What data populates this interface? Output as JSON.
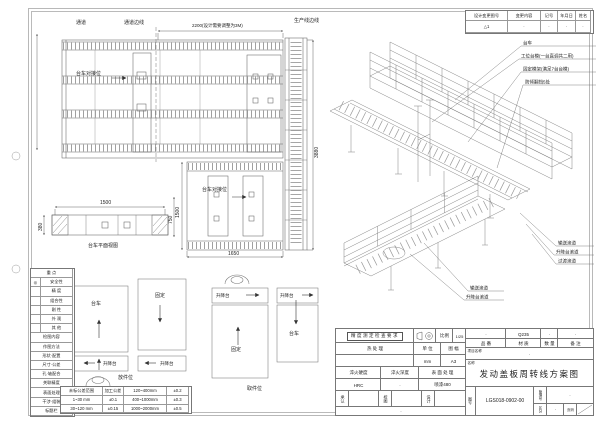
{
  "revision": {
    "headers": [
      "设计变更图号",
      "变更内容",
      "记号",
      "年月日",
      "姓名"
    ],
    "row": [
      "△1",
      "·",
      "·",
      "·",
      "·"
    ]
  },
  "plan_top": {
    "channel": "通道",
    "channel_edge": "通道边线",
    "dim_width": "2200(设计需要调整为3M)",
    "prod_edge": "生产线边线",
    "dock": "台车对接位",
    "dim_height": "3880"
  },
  "plan_lower": {
    "dock": "台车对接位",
    "dim_width": "1650",
    "dim_height": "1500"
  },
  "trolley": {
    "dim_length": "1500",
    "dim_width": "380",
    "dim_height": "750",
    "caption": "台车平面视图"
  },
  "iso": {
    "callouts_top": [
      "台车",
      "工位台模(一台直调共二用)",
      "固定模架(满足7台台模)",
      "防倾翻挡5处"
    ],
    "callouts_right": [
      "输送滚道",
      "升降台滚道",
      "过渡滚道"
    ],
    "callouts_bottom": [
      "输送滚道",
      "升降台滚道"
    ]
  },
  "schematic": {
    "trolley": "台车",
    "fixed": "固定",
    "lift": "升降台",
    "load_caption": "放件位",
    "unload_caption": "取件位"
  },
  "legend": {
    "title": "重  点",
    "rows": [
      {
        "mark": "◎",
        "label": "安全性"
      },
      {
        "mark": "",
        "label": "精  度"
      },
      {
        "mark": "",
        "label": "组合性"
      },
      {
        "mark": "",
        "label": "刚  性"
      },
      {
        "mark": "",
        "label": "外  观"
      },
      {
        "mark": "",
        "label": "其  他"
      }
    ],
    "check_title": "检图内容",
    "check_rows": [
      "作图方法",
      "形状·配置",
      "尺寸·公差",
      "孔·轴配合",
      "关联精度",
      "表面处理",
      "干涉·组装",
      "标题栏"
    ]
  },
  "tolerance": {
    "rows": [
      [
        "未标公差范围",
        "加工公差",
        "120~400mm",
        "±0.2"
      ],
      [
        "1~30 mm",
        "±0.1",
        "400~1000mm",
        "±0.3"
      ],
      [
        "30~120 mm",
        "±0.15",
        "1000~2000mm",
        "±0.5"
      ]
    ]
  },
  "titleblock": {
    "check_box": "精度测定检查要求",
    "scale_label": "比例",
    "scale_value": "1/25",
    "heat_label": "热  处  理",
    "unit_label": "单 位",
    "unit_value": "mm",
    "sheet_label": "图 幅",
    "sheet_value": "A3",
    "quench_hard_label": "淬火硬度",
    "quench_hard_value": "HRC",
    "quench_depth_label": "淬火深度",
    "quench_depth_value": "·",
    "surface_label": "表 面 处 理",
    "surface_value": "喷漆480",
    "approve_label": "承认",
    "check_label": "校图",
    "design_label": "设计",
    "part_no_label": "品 番",
    "part_no_value": "·",
    "material_label": "材 质",
    "material_value": "Q235",
    "qty_label": "数 量",
    "qty_value": "·",
    "remark_label": "备 注",
    "remark_value": "·",
    "project_label": "项目名称",
    "project_value": "·",
    "name_label": "名称",
    "title": "发动盖板周转线方案图",
    "dwg_no_label": "图号",
    "dwg_no": "LGS018-0902-00",
    "mgmt_label": "管理号",
    "mgmt_value": "·",
    "class_label": "区分",
    "class_value": "·",
    "page_label": "页码",
    "bottom_note": "·"
  }
}
